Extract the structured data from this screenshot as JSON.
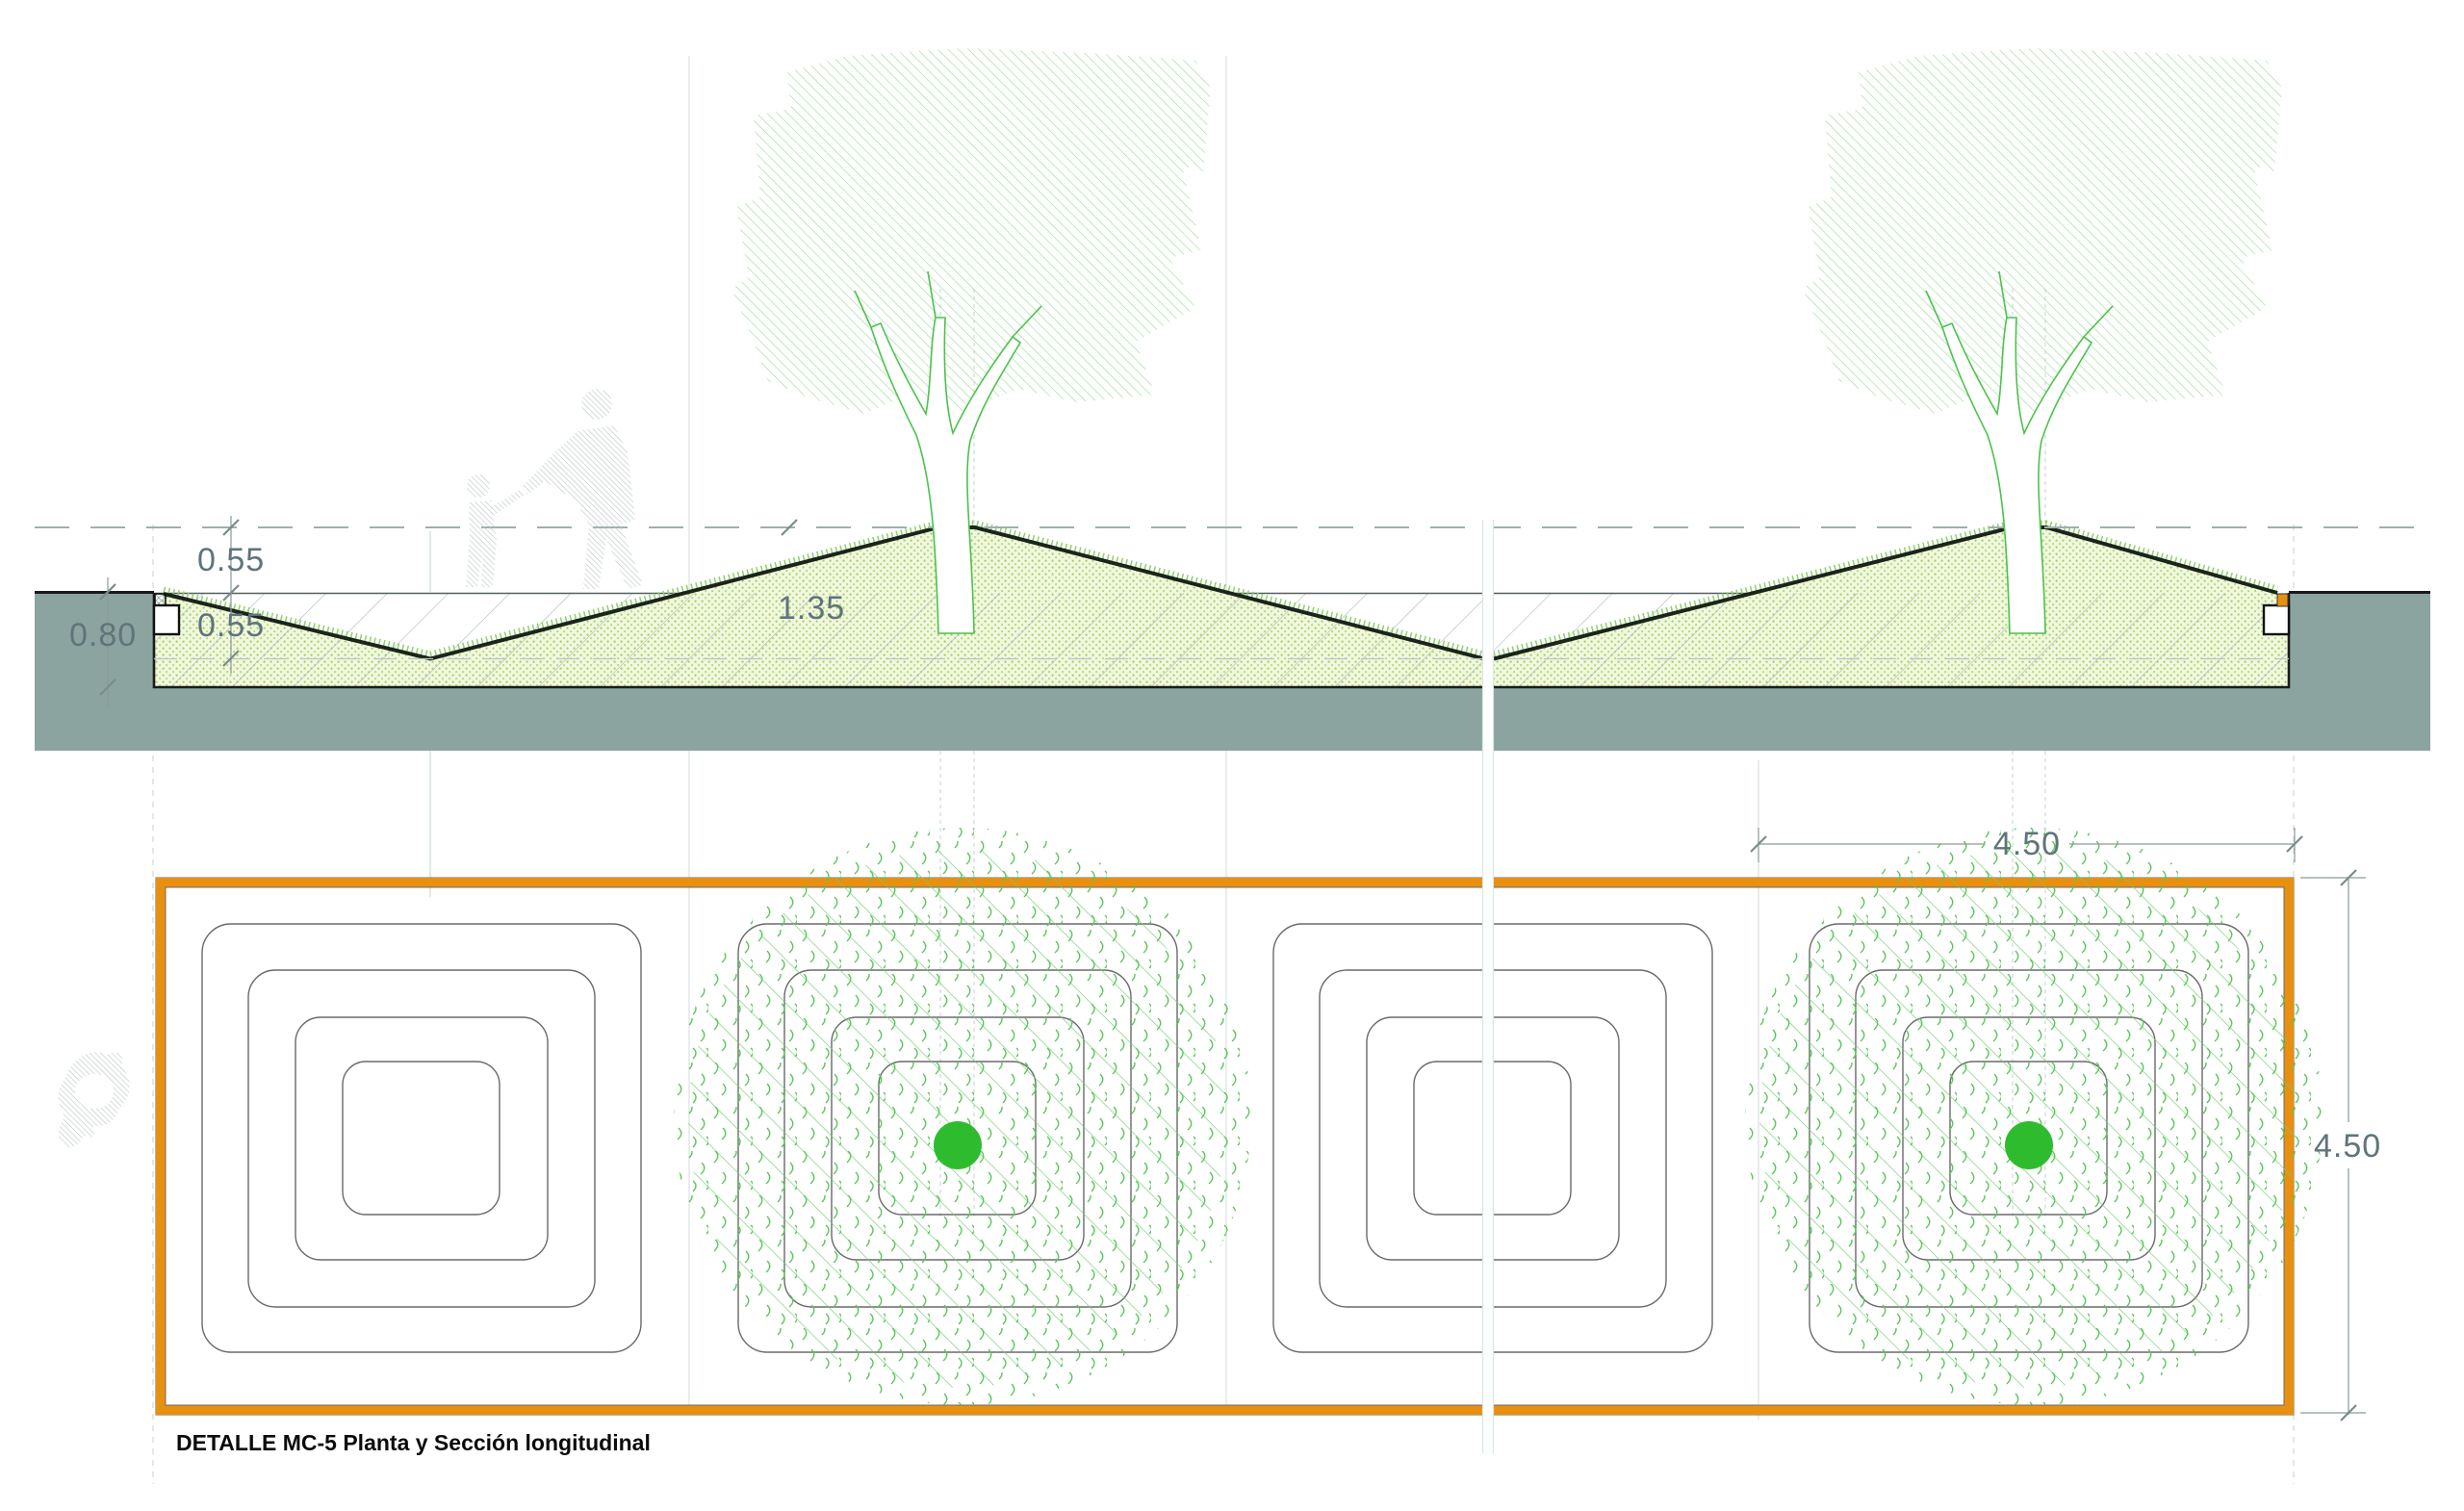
{
  "document": {
    "title": "DETALLE MC-5 Planta y Sección longitudinal"
  },
  "section": {
    "name": "Sección longitudinal",
    "dims": {
      "mound_height_above_grade": "0.55",
      "bed_depth_below_grade": "0.55",
      "edge_total_depth": "0.80",
      "total_mound_height": "1.35"
    }
  },
  "plan": {
    "name": "Planta",
    "dims": {
      "canopy_diameter": "4.50",
      "module_width": "4.50"
    },
    "planters": [
      {
        "id": 1,
        "tree": false
      },
      {
        "id": 2,
        "tree": true
      },
      {
        "id": 3,
        "tree": false
      },
      {
        "id": 4,
        "tree": true
      }
    ]
  },
  "colors": {
    "planter_frame_orange": "#E8900F",
    "tree_trunk_dot_green": "#2EBC2E",
    "ground_mass_gray": "#8BA49F",
    "canopy_green": "#93D893",
    "bed_fill_green": "#F1F7E0",
    "dim_text_gray": "#5F747B",
    "profile_dark": "#1B241B"
  }
}
